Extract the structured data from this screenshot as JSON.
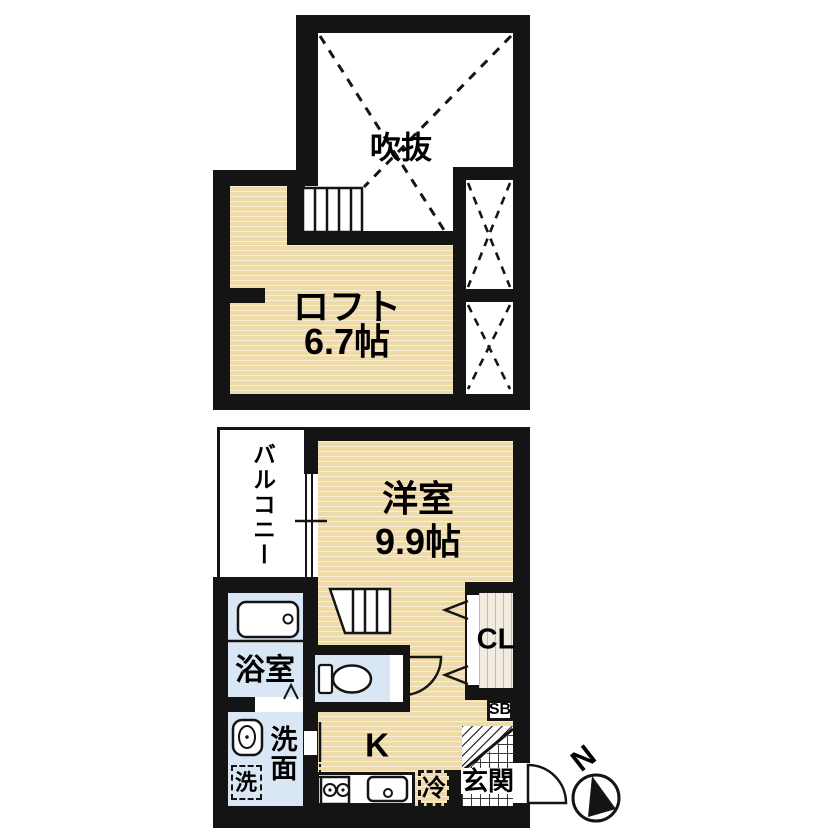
{
  "loft_floor": {
    "atrium": "吹抜",
    "loft": "ロフト",
    "loft_size": "6.7帖"
  },
  "main_floor": {
    "room": "洋室",
    "room_size": "9.9帖",
    "balcony": "バルコニー",
    "bath": "浴室",
    "washroom": "洗面",
    "washer": "洗",
    "kitchen": "K",
    "fridge": "冷",
    "entrance": "玄関",
    "closet": "CL",
    "shoe_box": "SB"
  },
  "compass": {
    "north": "N"
  },
  "colors": {
    "wall": "#141414",
    "floor_tan": "#EFDBAA",
    "wet_blue": "#D9E7F5",
    "closet_cream": "#F1EBE0"
  }
}
